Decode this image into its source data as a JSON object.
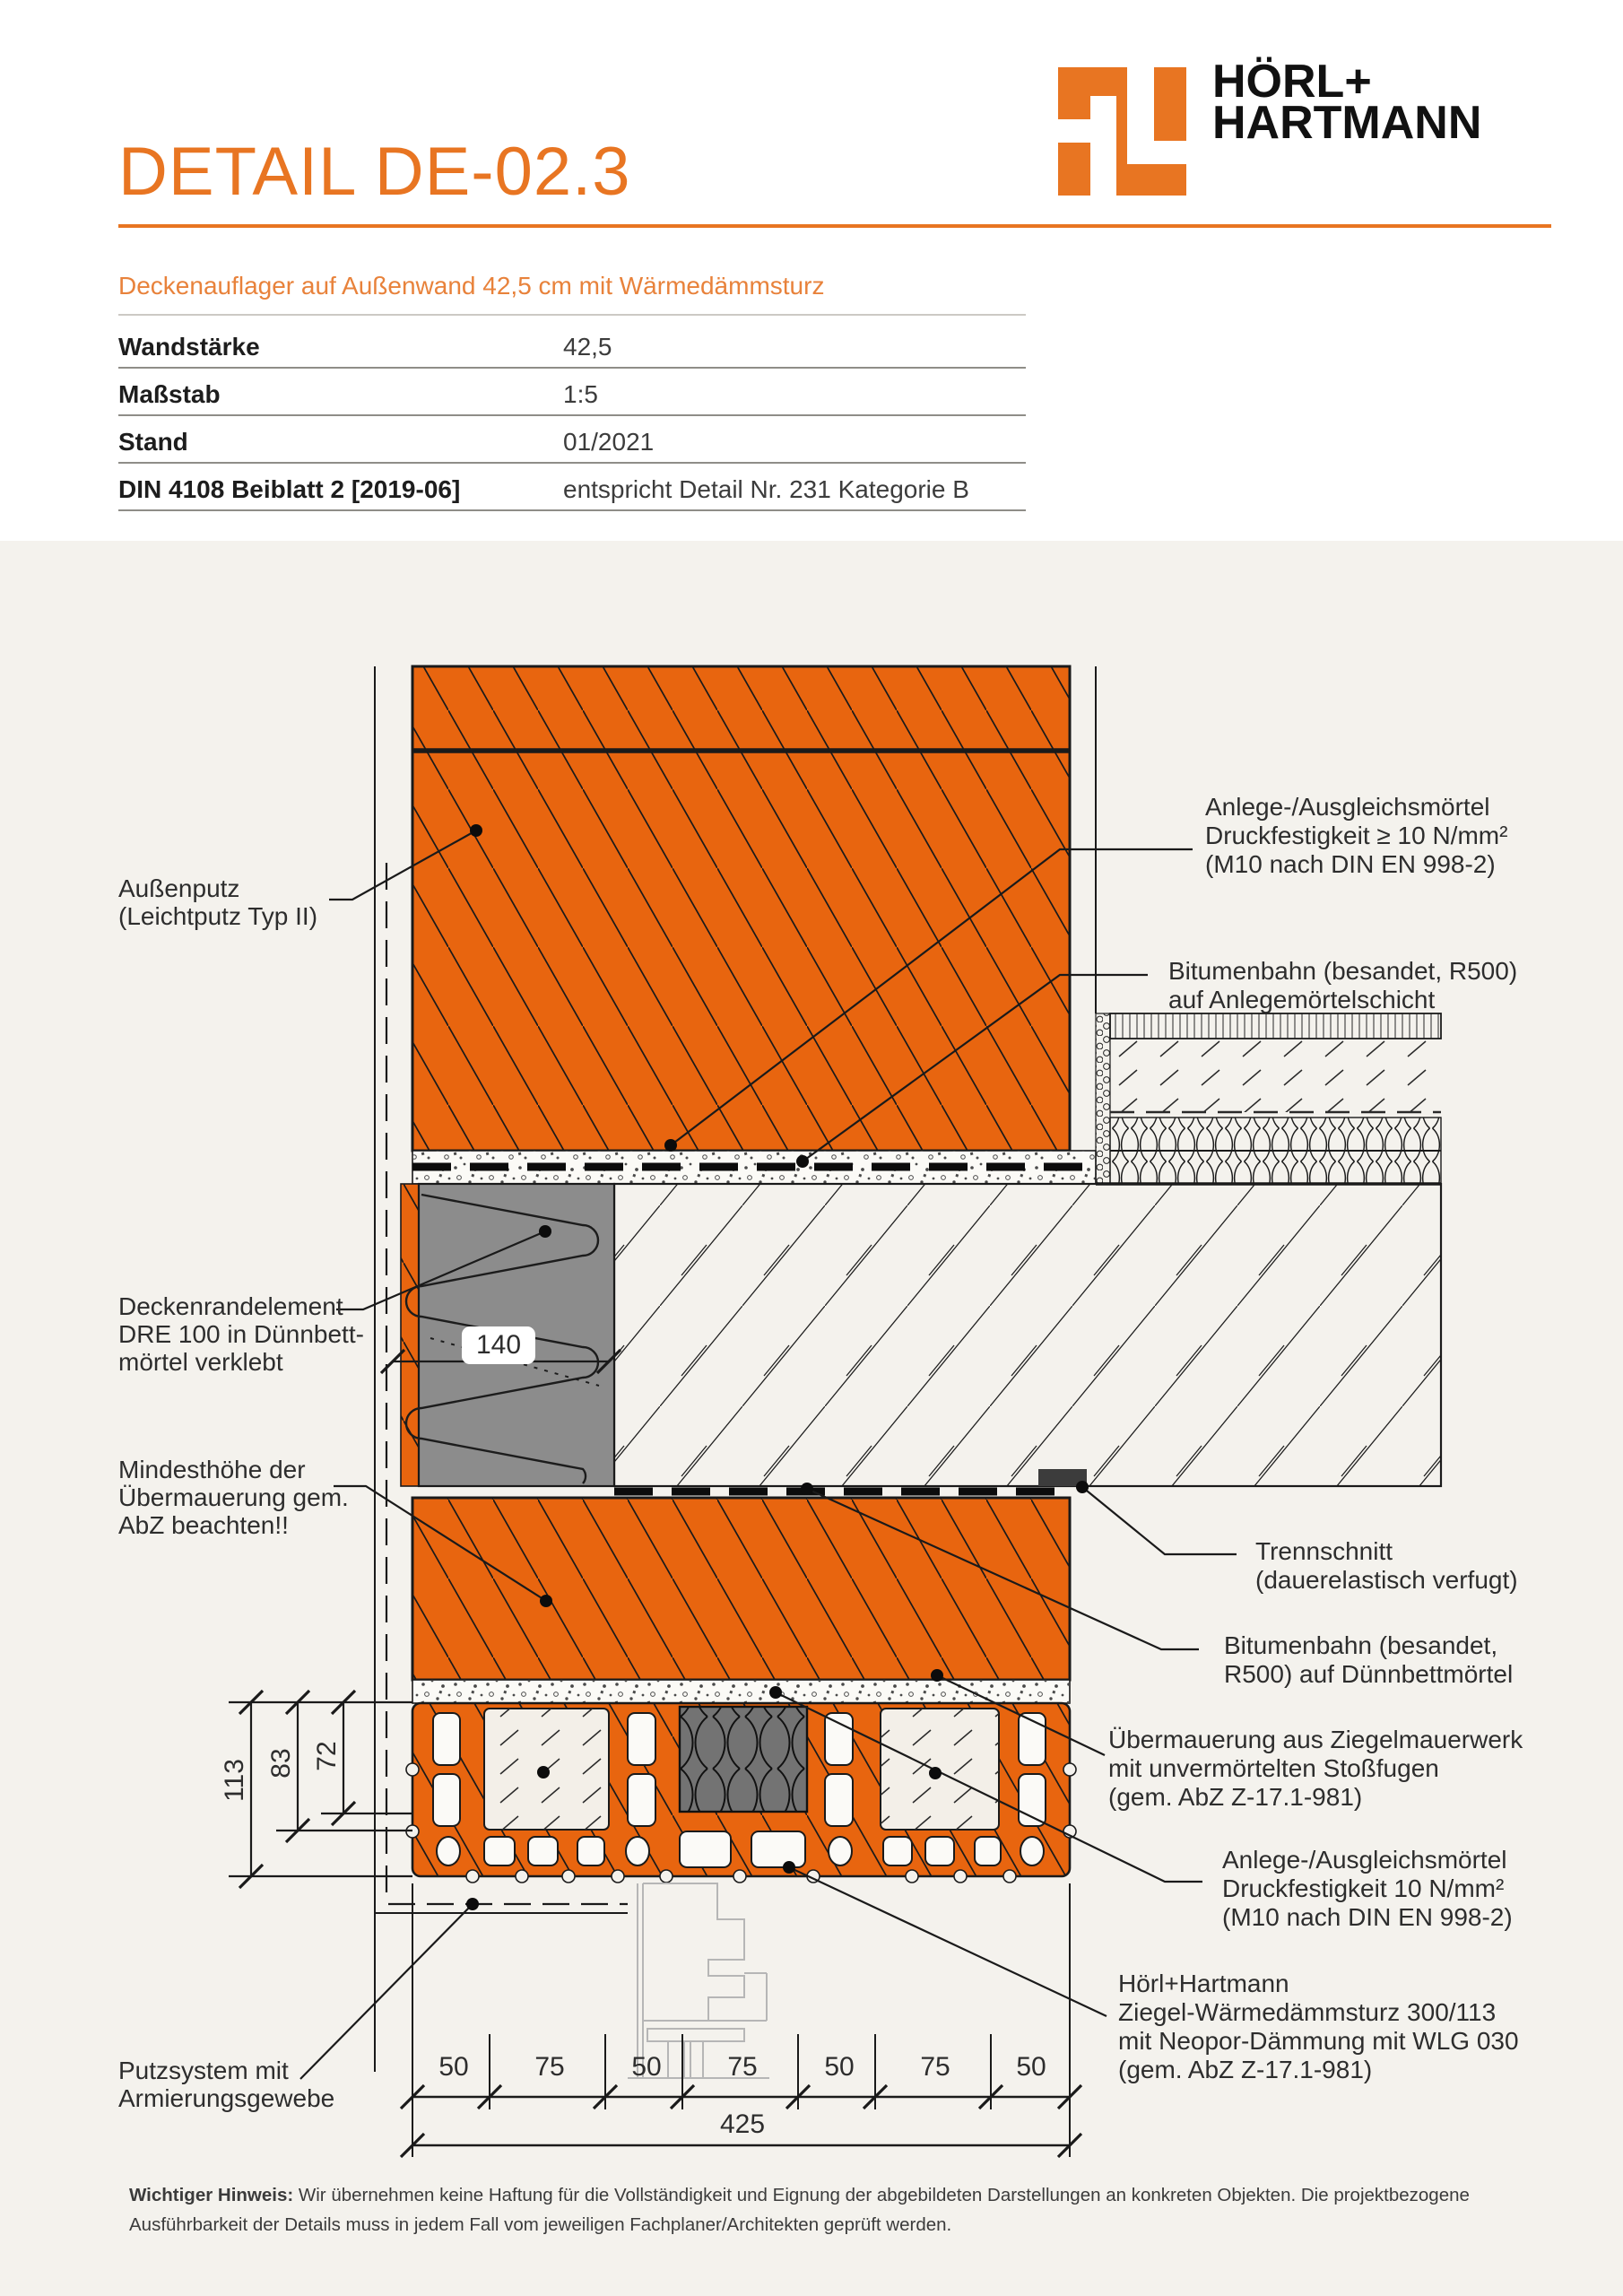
{
  "header": {
    "title": "DETAIL DE-02.3",
    "subtitle": "Deckenauflager auf Außenwand 42,5 cm mit Wärmedämmsturz",
    "logo": {
      "line1": "HÖRL+",
      "line2": "HARTMANN"
    }
  },
  "spec_table": {
    "rows": [
      {
        "label": "Wandstärke",
        "value": "42,5"
      },
      {
        "label": "Maßstab",
        "value": "1:5"
      },
      {
        "label": "Stand",
        "value": "01/2021"
      },
      {
        "label": "DIN 4108 Beiblatt 2 [2019-06]",
        "value": "entspricht Detail Nr. 231 Kategorie B"
      }
    ]
  },
  "drawing": {
    "labels_left": [
      {
        "lines": [
          "Außenputz",
          "(Leichtputz Typ II)"
        ]
      },
      {
        "lines": [
          "Deckenrandelement",
          "DRE 100 in Dünnbett-",
          "mörtel verklebt"
        ]
      },
      {
        "lines": [
          "Mindesthöhe der",
          "Übermauerung gem.",
          "AbZ beachten!!"
        ]
      },
      {
        "lines": [
          "Putzsystem mit",
          "Armierungsgewebe"
        ]
      }
    ],
    "labels_right": [
      {
        "lines": [
          "Anlege-/Ausgleichsmörtel",
          "Druckfestigkeit ≥ 10 N/mm²",
          "(M10 nach DIN EN 998-2)"
        ]
      },
      {
        "lines": [
          "Bitumenbahn (besandet, R500)",
          "auf Anlegemörtelschicht"
        ]
      },
      {
        "lines": [
          "Trennschnitt",
          "(dauerelastisch verfugt)"
        ]
      },
      {
        "lines": [
          "Bitumenbahn (besandet,",
          "R500) auf Dünnbettmörtel"
        ]
      },
      {
        "lines": [
          "Übermauerung aus Ziegelmauerwerk",
          "mit unvermörtelten Stoßfugen",
          "(gem. AbZ Z-17.1-981)"
        ]
      },
      {
        "lines": [
          "Anlege-/Ausgleichsmörtel",
          "Druckfestigkeit 10 N/mm²",
          "(M10 nach DIN EN 998-2)"
        ]
      },
      {
        "lines": [
          "Hörl+Hartmann",
          "Ziegel-Wärmedämmsturz 300/113",
          "mit Neopor-Dämmung mit WLG 030",
          "(gem. AbZ Z-17.1-981)"
        ]
      }
    ],
    "dims": {
      "bottom_segments": [
        "50",
        "75",
        "50",
        "75",
        "50",
        "75",
        "50"
      ],
      "total": "425",
      "left_vertical": [
        "113",
        "83",
        "72"
      ],
      "dre_width": "140"
    }
  },
  "footer": {
    "bold": "Wichtiger Hinweis:",
    "line1": " Wir übernehmen keine Haftung für die Vollständigkeit und Eignung der abgebildeten Darstellungen an konkreten Objekten. Die projektbezogene",
    "line2": "Ausführbarkeit der Details muss in jedem Fall vom jeweiligen Fachplaner/Architekten geprüft werden."
  },
  "colors": {
    "brand_orange": "#e87522",
    "subtitle_orange": "#e8823b",
    "brick_orange": "#e8650f",
    "sheet_beige": "#f4f2ed",
    "line_black": "#1a1a1a",
    "dre_gray": "#8c8c8c",
    "neopor_gray": "#737373",
    "trennschnitt_dark": "#3c3c3c",
    "window_gray": "#b6b6b6"
  }
}
